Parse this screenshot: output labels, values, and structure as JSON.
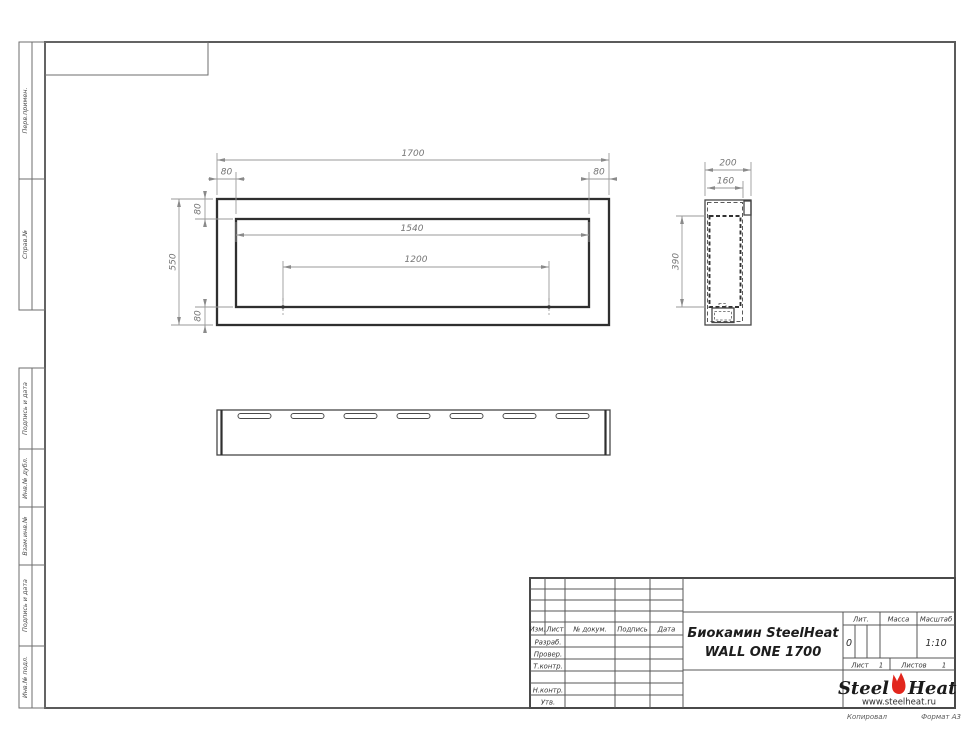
{
  "sheet": {
    "margin_boxes": [
      {
        "label": "Перв.примен."
      },
      {
        "label": "Справ.№"
      },
      {
        "label": "Подпись и дата"
      },
      {
        "label": "Инв.№ дубл."
      },
      {
        "label": "Взам.инв.№"
      },
      {
        "label": "Подпись и дата"
      },
      {
        "label": "Инв.№ подл."
      }
    ],
    "footer": {
      "copied": "Копировал",
      "format": "Формат А3"
    }
  },
  "views": {
    "front": {
      "dim_total_width": "1700",
      "dim_margin_left": "80",
      "dim_margin_right": "80",
      "dim_inner_width": "1540",
      "dim_mount_spacing": "1200",
      "dim_total_height": "550",
      "dim_margin_top": "80",
      "dim_margin_bottom": "80"
    },
    "side": {
      "dim_depth": "200",
      "dim_inner_depth": "160",
      "dim_height": "390"
    }
  },
  "title_block": {
    "cols": {
      "izm": "Изм.",
      "list": "Лист",
      "doc": "№ докум.",
      "sign": "Подпись",
      "date": "Дата"
    },
    "rows": {
      "razrab": "Разраб.",
      "prover": "Провер.",
      "tkontr": "Т.контр.",
      "nkontr": "Н.контр.",
      "utv": "Утв."
    },
    "title_line1": "Биокамин SteelHeat",
    "title_line2": "WALL ONE 1700",
    "lit_label": "Лит.",
    "lit_value": "0",
    "mass_label": "Масса",
    "scale_label": "Масштаб",
    "scale_value": "1:10",
    "sheet_label": "Лист",
    "sheet_value": "1",
    "sheets_label": "Листов",
    "sheets_value": "1",
    "logo_steel": "Steel",
    "logo_heat": "Heat",
    "logo_url": "www.steelheat.ru"
  },
  "colors": {
    "flame": "#e2261d",
    "object_line": "#2f2f2f",
    "dim_line": "#9a9a9a"
  }
}
